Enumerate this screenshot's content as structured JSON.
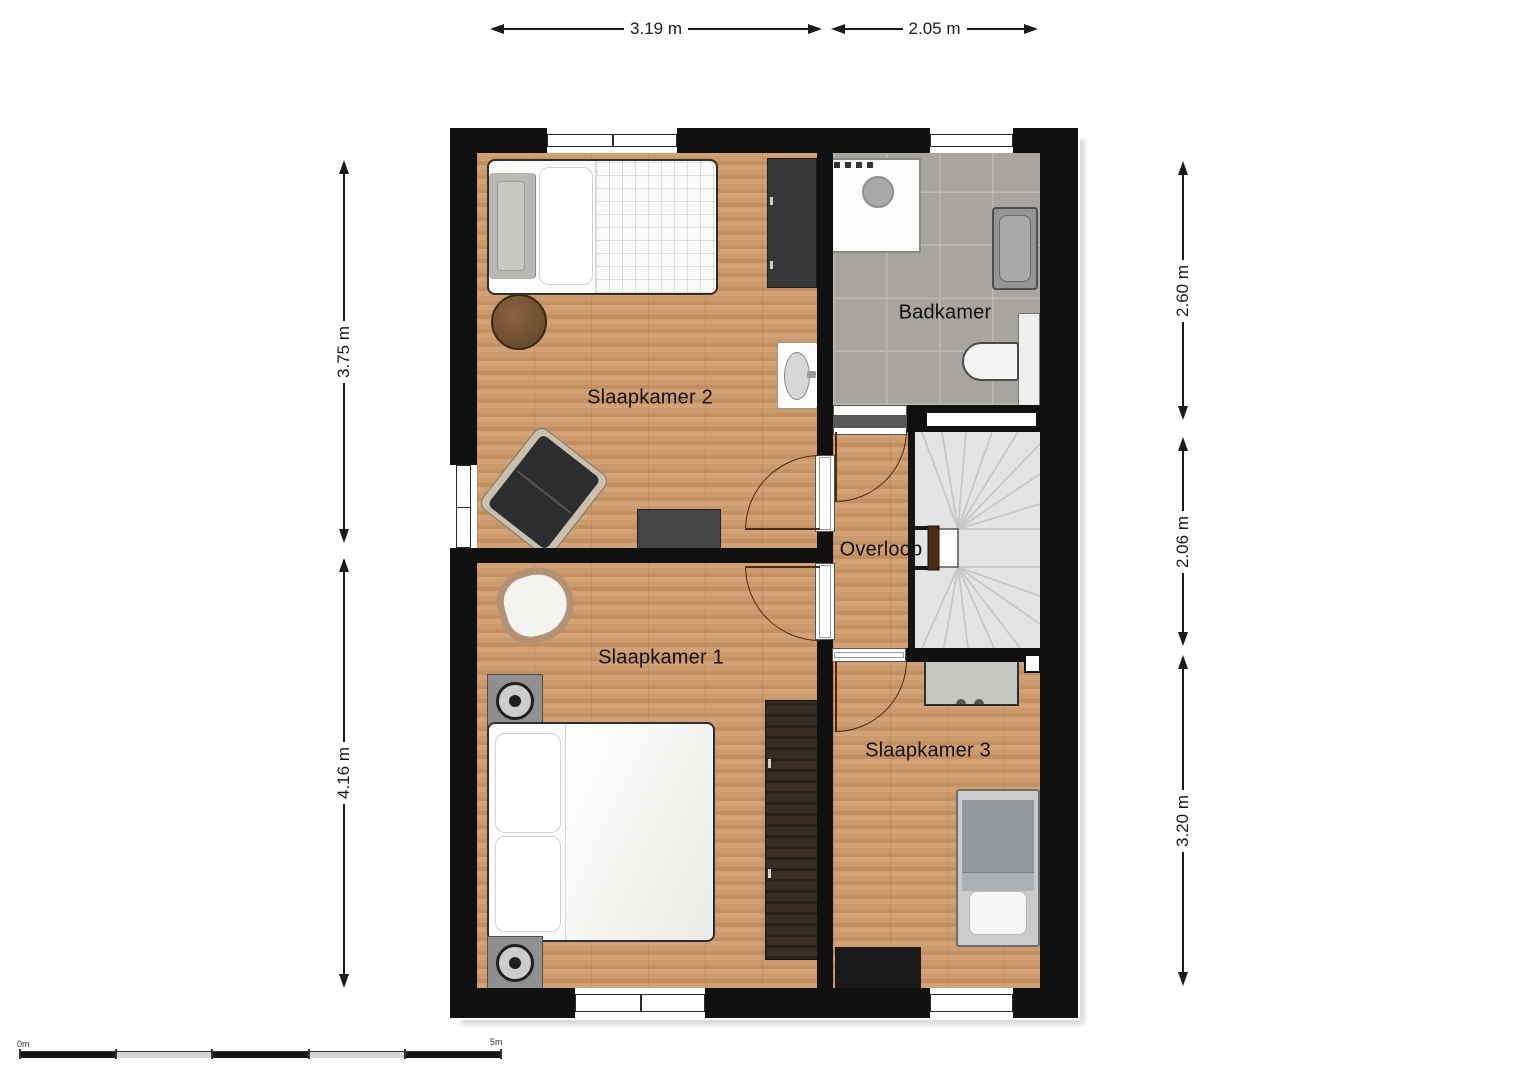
{
  "dimensions": {
    "top": [
      "3.19 m",
      "2.05 m"
    ],
    "left": [
      "3.75 m",
      "4.16 m"
    ],
    "right": [
      "2.60 m",
      "2.06 m",
      "3.20 m"
    ]
  },
  "rooms": {
    "slaapkamer2": "Slaapkamer 2",
    "badkamer": "Badkamer",
    "overloop": "Overloop",
    "slaapkamer1": "Slaapkamer 1",
    "slaapkamer3": "Slaapkamer 3"
  },
  "scale": {
    "start": "0m",
    "end": "5m"
  },
  "colors": {
    "wall": "#101010",
    "wood": "#cb9a6d",
    "tile": "#a8a5a0",
    "tile-grout": "#bdbab4",
    "stair": "#e3e3e1",
    "stair-line": "#c7c7c5",
    "newel": "#4a2b15",
    "door": "#4a2c13",
    "dim": "#1a1a1a",
    "label": "#111111"
  }
}
